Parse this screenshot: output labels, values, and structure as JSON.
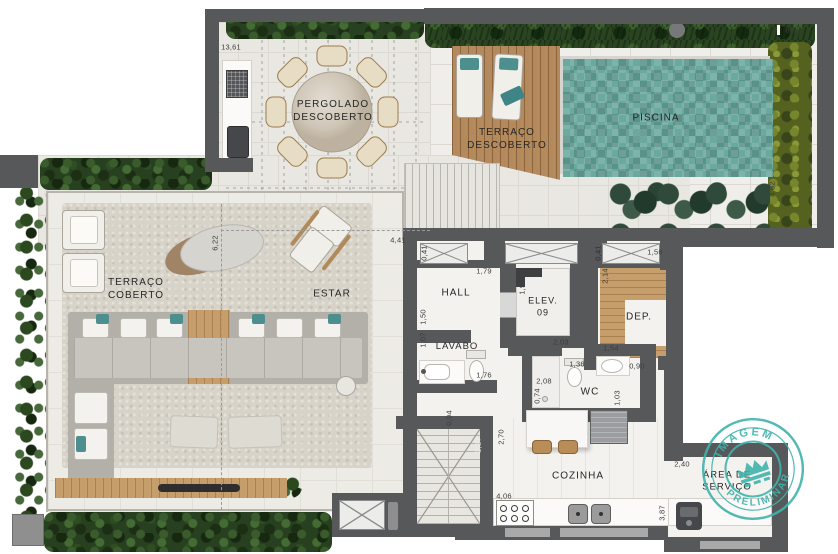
{
  "watermark": {
    "top": "IMAGEM",
    "bottom": "PRELIMINAR",
    "color": "#3fb3ab"
  },
  "rooms": {
    "pergolado": "PERGOLADO\nDESCOBERTO",
    "terraco_descoberto": "TERRAÇO\nDESCOBERTO",
    "piscina": "PISCINA",
    "terraco_coberto": "TERRAÇO\nCOBERTO",
    "estar": "ESTAR",
    "hall": "HALL",
    "elevador": "ELEV.\n09",
    "deposito": "DEP.",
    "lavabo": "LAVABO",
    "wc": "WC",
    "cozinha": "COZINHA",
    "area_servico": "ÁREA DE\nSERVIÇO"
  },
  "dims": {
    "terrace_top": "13,61",
    "pool_terrace_width": "8,98",
    "pool_terrace_depth": "4,82",
    "estar_width": "4,41",
    "living_depth": "6,22",
    "shaft_left": "0,41",
    "shaft_right": "0,41",
    "hall_width": "1,79",
    "dep_shaft": "1,56",
    "elev_depth": "1,97",
    "dep_depth": "2,14",
    "hall_depth": "1,50",
    "elev_width": "2,03",
    "dep_width": "1,54",
    "lavabo_depth": "1,07",
    "lavabo_width": "1,76",
    "wc_door": "1,36",
    "dep_door": "0,90",
    "shower_depth": "2,08",
    "shower_width": "0,74",
    "wc_depth": "1,03",
    "corridor_width": "0,94",
    "stair_width": "2,27",
    "kitchen_depth": "2,70",
    "area_servico_width": "2,40",
    "kitchen_width": "4,06",
    "kitchen_run": "3,87"
  },
  "colors": {
    "wall": "#57585a",
    "hedge_green": "#27401f",
    "pool_teal": "#6ba89e",
    "wood_tan": "#c69e6c",
    "watermark_teal": "#3fb3ab"
  }
}
